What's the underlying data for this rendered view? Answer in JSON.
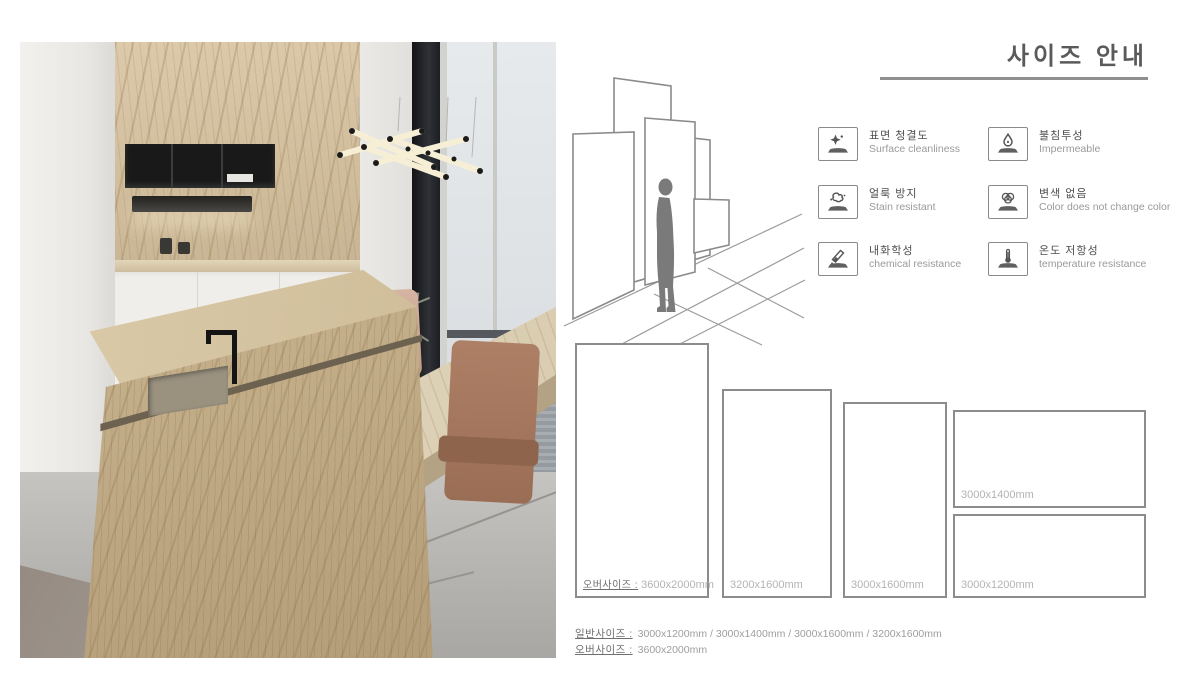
{
  "header": {
    "title": "사이즈 안내"
  },
  "features": [
    {
      "icon": "sparkle-surface-icon",
      "kr": "표면 청결도",
      "en": "Surface cleanliness"
    },
    {
      "icon": "water-drop-icon",
      "kr": "불침투성",
      "en": "Impermeable"
    },
    {
      "icon": "stain-splash-icon",
      "kr": "얼룩 방지",
      "en": "Stain resistant"
    },
    {
      "icon": "color-circles-icon",
      "kr": "변색 없음",
      "en": "Color does not change color"
    },
    {
      "icon": "chemical-tube-icon",
      "kr": "내화학성",
      "en": "chemical resistance"
    },
    {
      "icon": "thermometer-icon",
      "kr": "온도 저항성",
      "en": "temperature resistance"
    }
  ],
  "slabs": [
    {
      "prefix": "오버사이즈 :",
      "size": "3600x2000mm"
    },
    {
      "size": "3200x1600mm"
    },
    {
      "size": "3000x1600mm"
    },
    {
      "size": "3000x1400mm"
    },
    {
      "size": "3000x1200mm"
    }
  ],
  "summary": [
    {
      "label": "일반사이즈 :",
      "value": "3000x1200mm / 3000x1400mm / 3000x1600mm / 3200x1600mm"
    },
    {
      "label": "오버사이즈 :",
      "value": "3600x2000mm"
    }
  ],
  "colors": {
    "title_text": "#5a5a5a",
    "rule": "#8f8f8f",
    "slab_border": "#8c8c8c",
    "label_muted": "#b3b3b3",
    "label_dark": "#6f6f6f",
    "marble_beige": "#cbb893",
    "chair_brown": "#9a6d55"
  }
}
